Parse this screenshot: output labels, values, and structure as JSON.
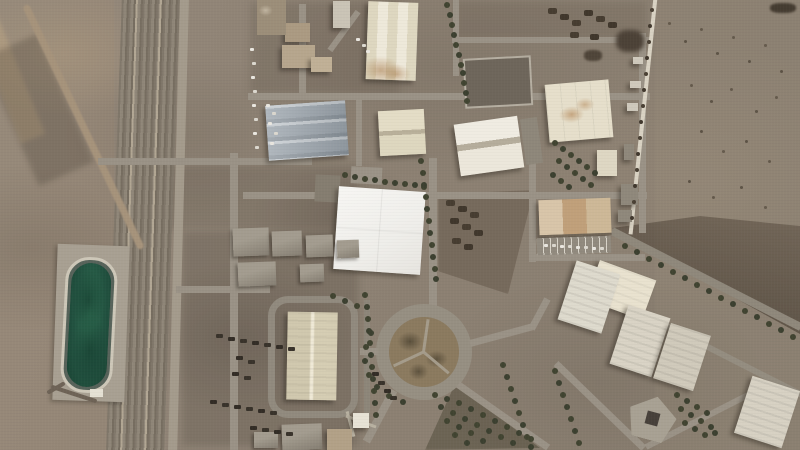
{
  "scene": {
    "type": "satellite-photo",
    "title": "Aerial satellite view of a desert industrial facility with warehouses, a green wastewater pond, a railway corridor, a tree-lined roundabout and a perimeter wall",
    "visible_text": "none",
    "landmarks": [
      "railway-corridor-west",
      "green-wastewater-pond",
      "striped-warehouse-north",
      "metal-roof-warehouse",
      "large-white-central-hall",
      "tan-building-with-parking",
      "tree-lined-roundabout",
      "perimeter-wall-east",
      "dark-graded-field-northeast",
      "rotated-warehouse-rows-southeast",
      "pentagon-building-southeast"
    ],
    "palette": {
      "desert": "#8e8375",
      "desert_light": "#a09480",
      "desert_dark": "#776c5f",
      "road": "#9a9286",
      "building_white": "#f4f3f0",
      "building_cream": "#e2dbc4",
      "metal_roof": "#9aa3ab",
      "pond_water": "#265c47",
      "pond_rim": "#cdc7b8",
      "tree": "#414431",
      "dark_field": "#5a4e41",
      "wall": "#d9d2c3"
    }
  }
}
